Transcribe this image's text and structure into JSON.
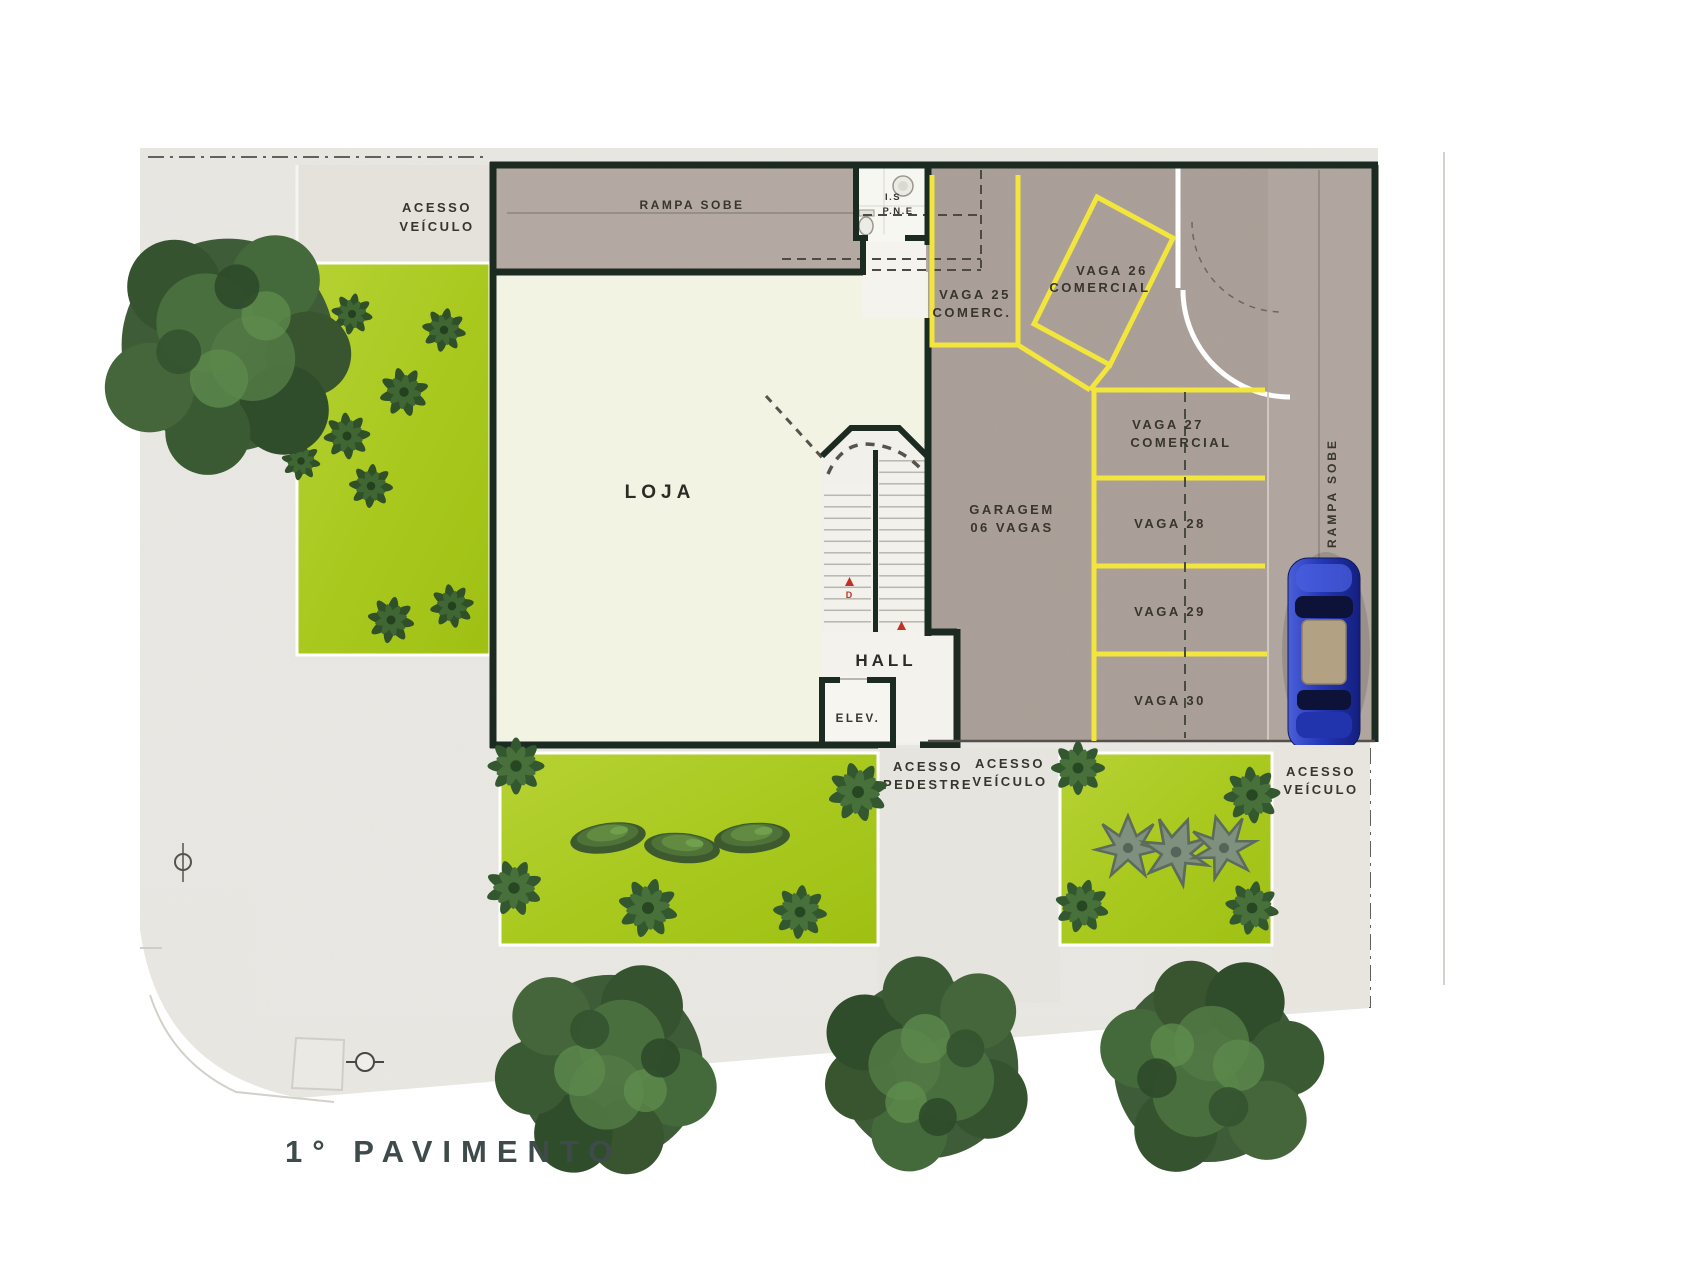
{
  "title": {
    "floor": "1° PAVIMENTO"
  },
  "rooms": {
    "loja": "LOJA",
    "hall": "HALL",
    "elevator": "ELEV.",
    "bath_line1": "I.S",
    "bath_line2": "P.N.E"
  },
  "garage": {
    "line1": "GARAGEM",
    "line2": "06 VAGAS"
  },
  "ramps": {
    "top": "RAMPA SOBE",
    "side": "RAMPA SOBE"
  },
  "access": {
    "vehicle_top": {
      "line1": "ACESSO",
      "line2": "VEÍCULO"
    },
    "pedestrian": {
      "line1": "ACESSO",
      "line2": "PEDESTRE"
    },
    "vehicle_center": {
      "line1": "ACESSO",
      "line2": "VEÍCULO"
    },
    "vehicle_right": {
      "line1": "ACESSO",
      "line2": "VEÍCULO"
    }
  },
  "parking": {
    "vaga25": {
      "line1": "VAGA 25",
      "line2": "COMERC."
    },
    "vaga26": {
      "line1": "VAGA 26",
      "line2": "COMERCIAL"
    },
    "vaga27": {
      "line1": "VAGA 27",
      "line2": "COMERCIAL"
    },
    "vaga28": {
      "label": "VAGA 28"
    },
    "vaga29": {
      "label": "VAGA 29"
    },
    "vaga30": {
      "label": "VAGA 30"
    }
  },
  "stairs": {
    "down": "D",
    "up": "S"
  },
  "colors": {
    "wall": "#1c2b22",
    "loja_fill": "#f2f3e2",
    "garage_fill": "#aba099",
    "corridor_fill": "#b4aaa3",
    "garden_green": "#a9c91f",
    "parking_yellow": "#f2e53c",
    "sidewalk": "#e9e8e3",
    "car_blue": "#2b3fc0",
    "label_text": "#37352c",
    "title_text": "#3f4b4a"
  }
}
